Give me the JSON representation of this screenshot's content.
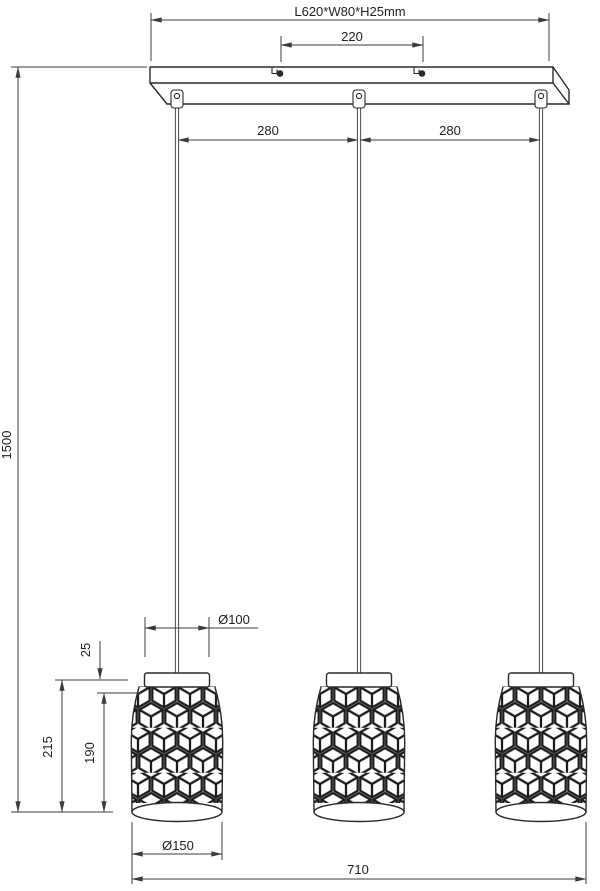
{
  "drawing": {
    "type": "technical-dimension-drawing",
    "subject": "3-light pendant lamp with patterned shades",
    "dimensions": {
      "canopy": "L620*W80*H25mm",
      "mount_spacing": "220",
      "cord_spacing_1": "280",
      "cord_spacing_2": "280",
      "drop": "1500",
      "shade_height": "215",
      "body_height": "190",
      "cap_height": "25",
      "cap_dia": "Ø100",
      "shade_dia": "Ø150",
      "overall_width": "710"
    },
    "colors": {
      "line": "#2a2a2a",
      "dim": "#3c3c3c",
      "text": "#1f1f1f",
      "cord": "#4d4d4d",
      "bg": "#ffffff"
    }
  }
}
